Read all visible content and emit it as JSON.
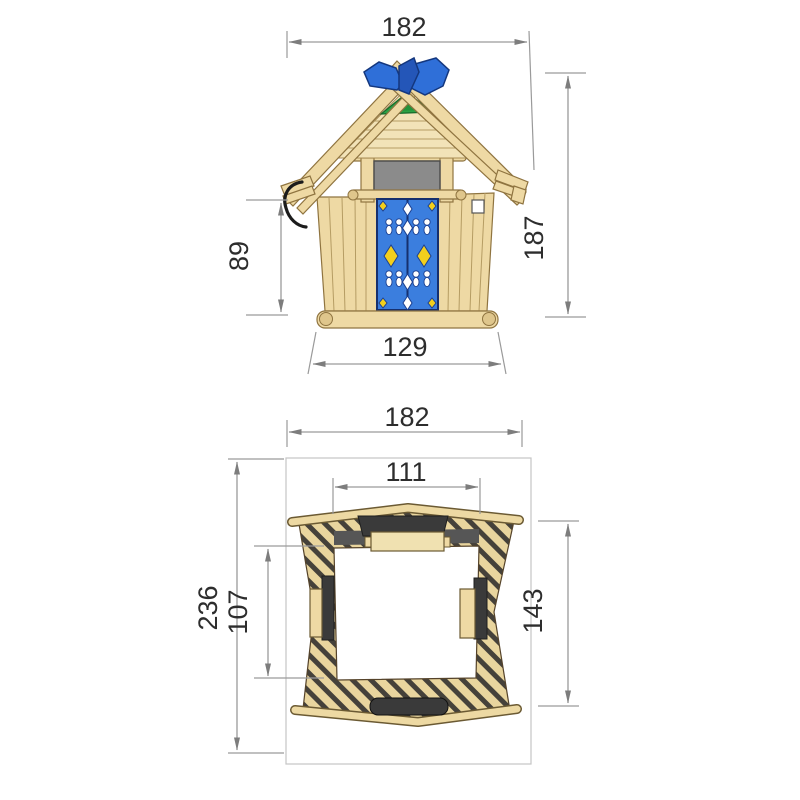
{
  "drawing": {
    "type": "technical-dimension-drawing",
    "subject": "wooden crooked playhouse",
    "views": {
      "front": "front-elevation",
      "plan": "top-plan"
    }
  },
  "dims": {
    "front_width": "182",
    "front_total_height": "187",
    "front_eave_height": "89",
    "front_base_width": "129",
    "plan_width": "182",
    "plan_front_opening_width": "111",
    "plan_total_depth": "236",
    "plan_inner_depth": "107",
    "plan_side_depth": "143"
  },
  "colors": {
    "wood": "#eed9a4",
    "wood_outline": "#8f7440",
    "door_blue": "#3b7ede",
    "finial_blue": "#2f6fd8",
    "accent_green": "#2ba244",
    "accent_yellow": "#f2cf1d",
    "shutter_gray": "#8b8b8b",
    "plan_dark": "#3a3a3a",
    "dimension_line": "#9a9a9a",
    "dimension_text": "#2d2d2d"
  }
}
